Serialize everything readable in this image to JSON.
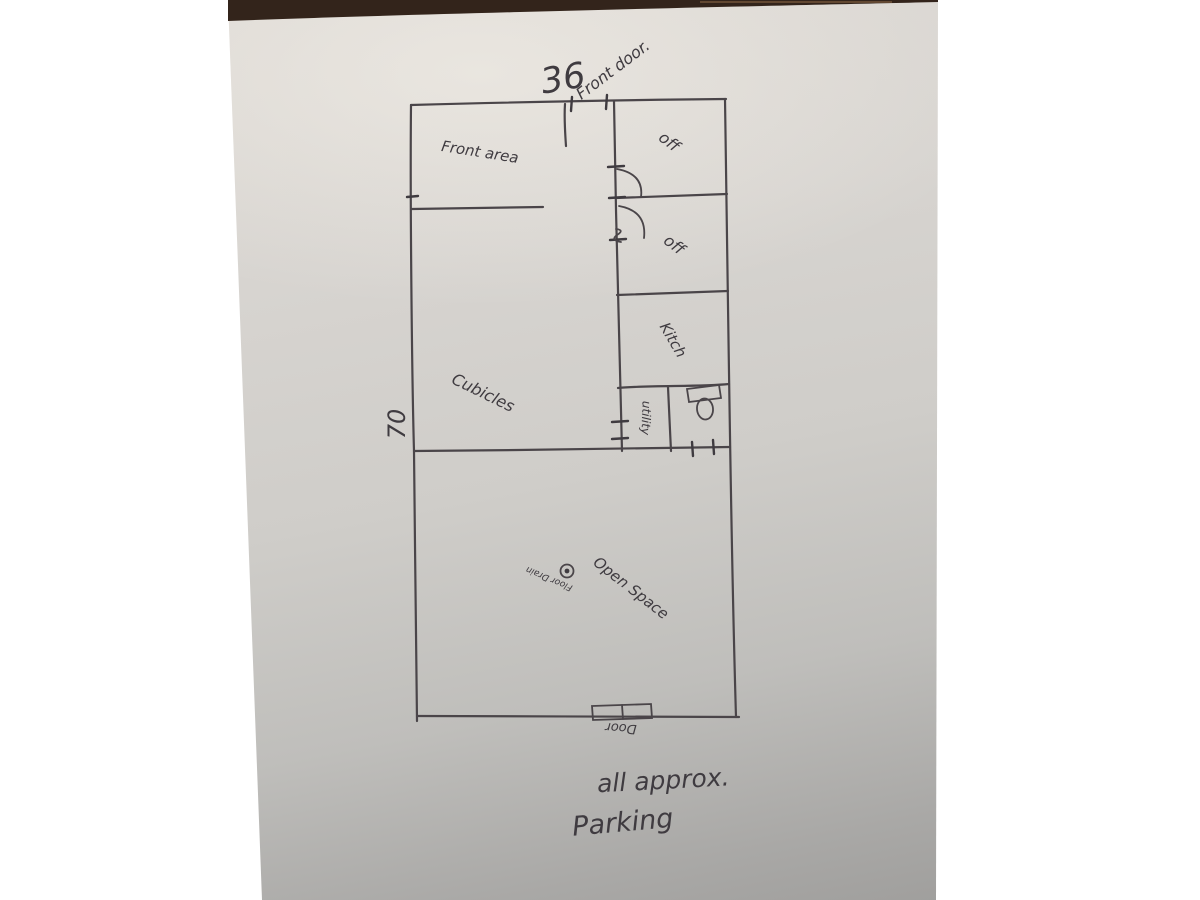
{
  "meta": {
    "description": "Photo of a hand-drawn office floor plan sketch in pen on paper"
  },
  "colors": {
    "background": "#ffffff",
    "paper_top": "#ddd9d4",
    "paper_bottom": "#9b9a98",
    "table_edge": "#33241b",
    "ink": "#3f3b40"
  },
  "labels": {
    "top_width": "36",
    "front_door": "Front door.",
    "front_area": "Front area",
    "office_1": "off",
    "office_2": "off",
    "kitchen": "Kitch",
    "utility": "utility",
    "left_height": "70",
    "cubicles": "Cubicles",
    "open_space": "Open Space",
    "floor_drain": "Floor Drain",
    "rear_door": "Door",
    "note_all_approx": "all approx.",
    "note_parking": "Parking"
  },
  "icons": {
    "toilet": "toilet-icon",
    "floor_drain": "floor-drain-icon",
    "rear_double_door": "double-door-icon",
    "office_doors": "door-swing-arc-icon"
  }
}
